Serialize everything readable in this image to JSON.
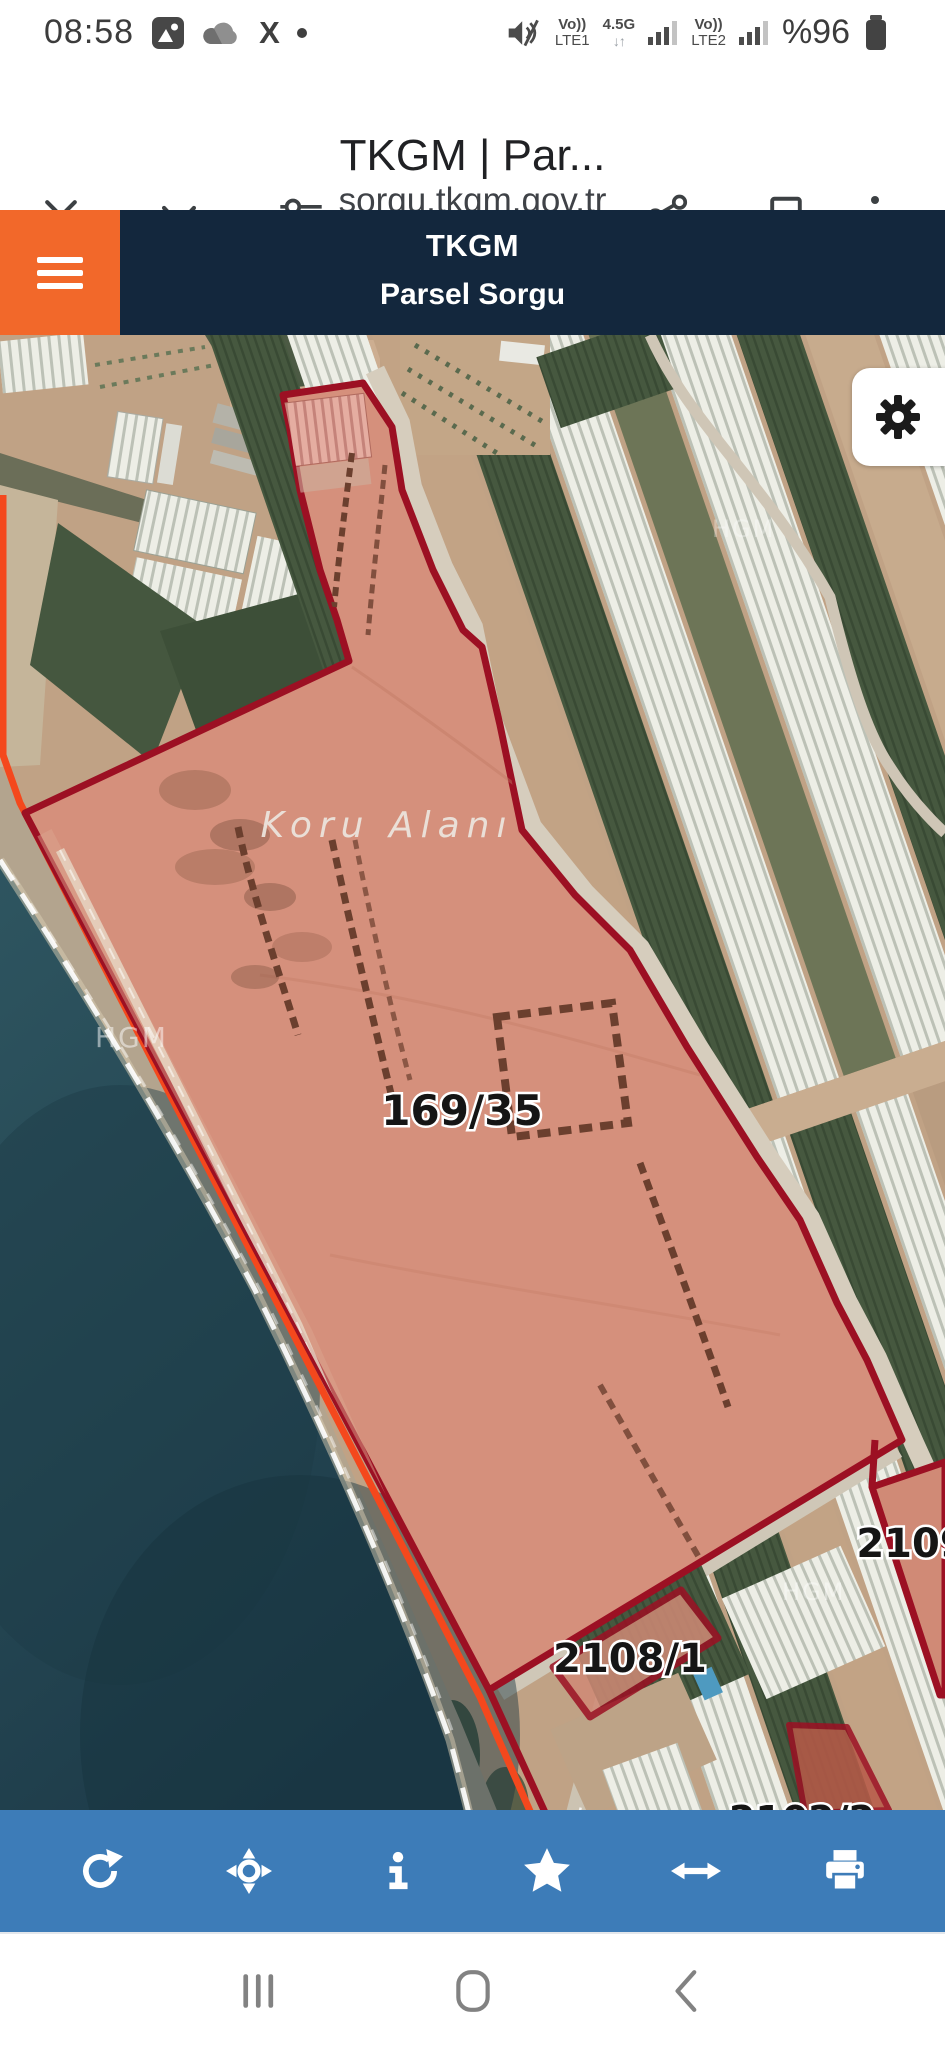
{
  "status_bar": {
    "time": "08:58",
    "volte1": "Vo))",
    "net1": "LTE1",
    "speed": "4.5G",
    "arrows": "↓↑",
    "volte2": "Vo))",
    "net2": "LTE2",
    "battery": "%96"
  },
  "browser": {
    "title": "TKGM | Par...",
    "url": "sorgu.tkgm.gov.tr"
  },
  "header": {
    "app": "TKGM",
    "subtitle": "Parsel Sorgu"
  },
  "map": {
    "labels": {
      "area": "Koru Alanı",
      "parcel_main": "169/35",
      "parcel_a": "2108/1",
      "parcel_b": "2109",
      "parcel_c": "2102/2"
    },
    "watermark": "HGM"
  },
  "toolbar": {
    "icons": [
      "refresh",
      "locate",
      "info",
      "favorite",
      "measure",
      "print"
    ]
  },
  "nav_bar": {
    "icons": [
      "recents",
      "home",
      "back"
    ]
  },
  "colors": {
    "orange": "#f2682a",
    "navy": "#13273d",
    "toolbar-blue": "#3d7cb8",
    "boundary-red": "#9c1023",
    "coast-orange": "#f4481d",
    "parcel-fill": "#d5907c",
    "sea-deep": "#1c3947",
    "sea-top": "#2e5560"
  }
}
